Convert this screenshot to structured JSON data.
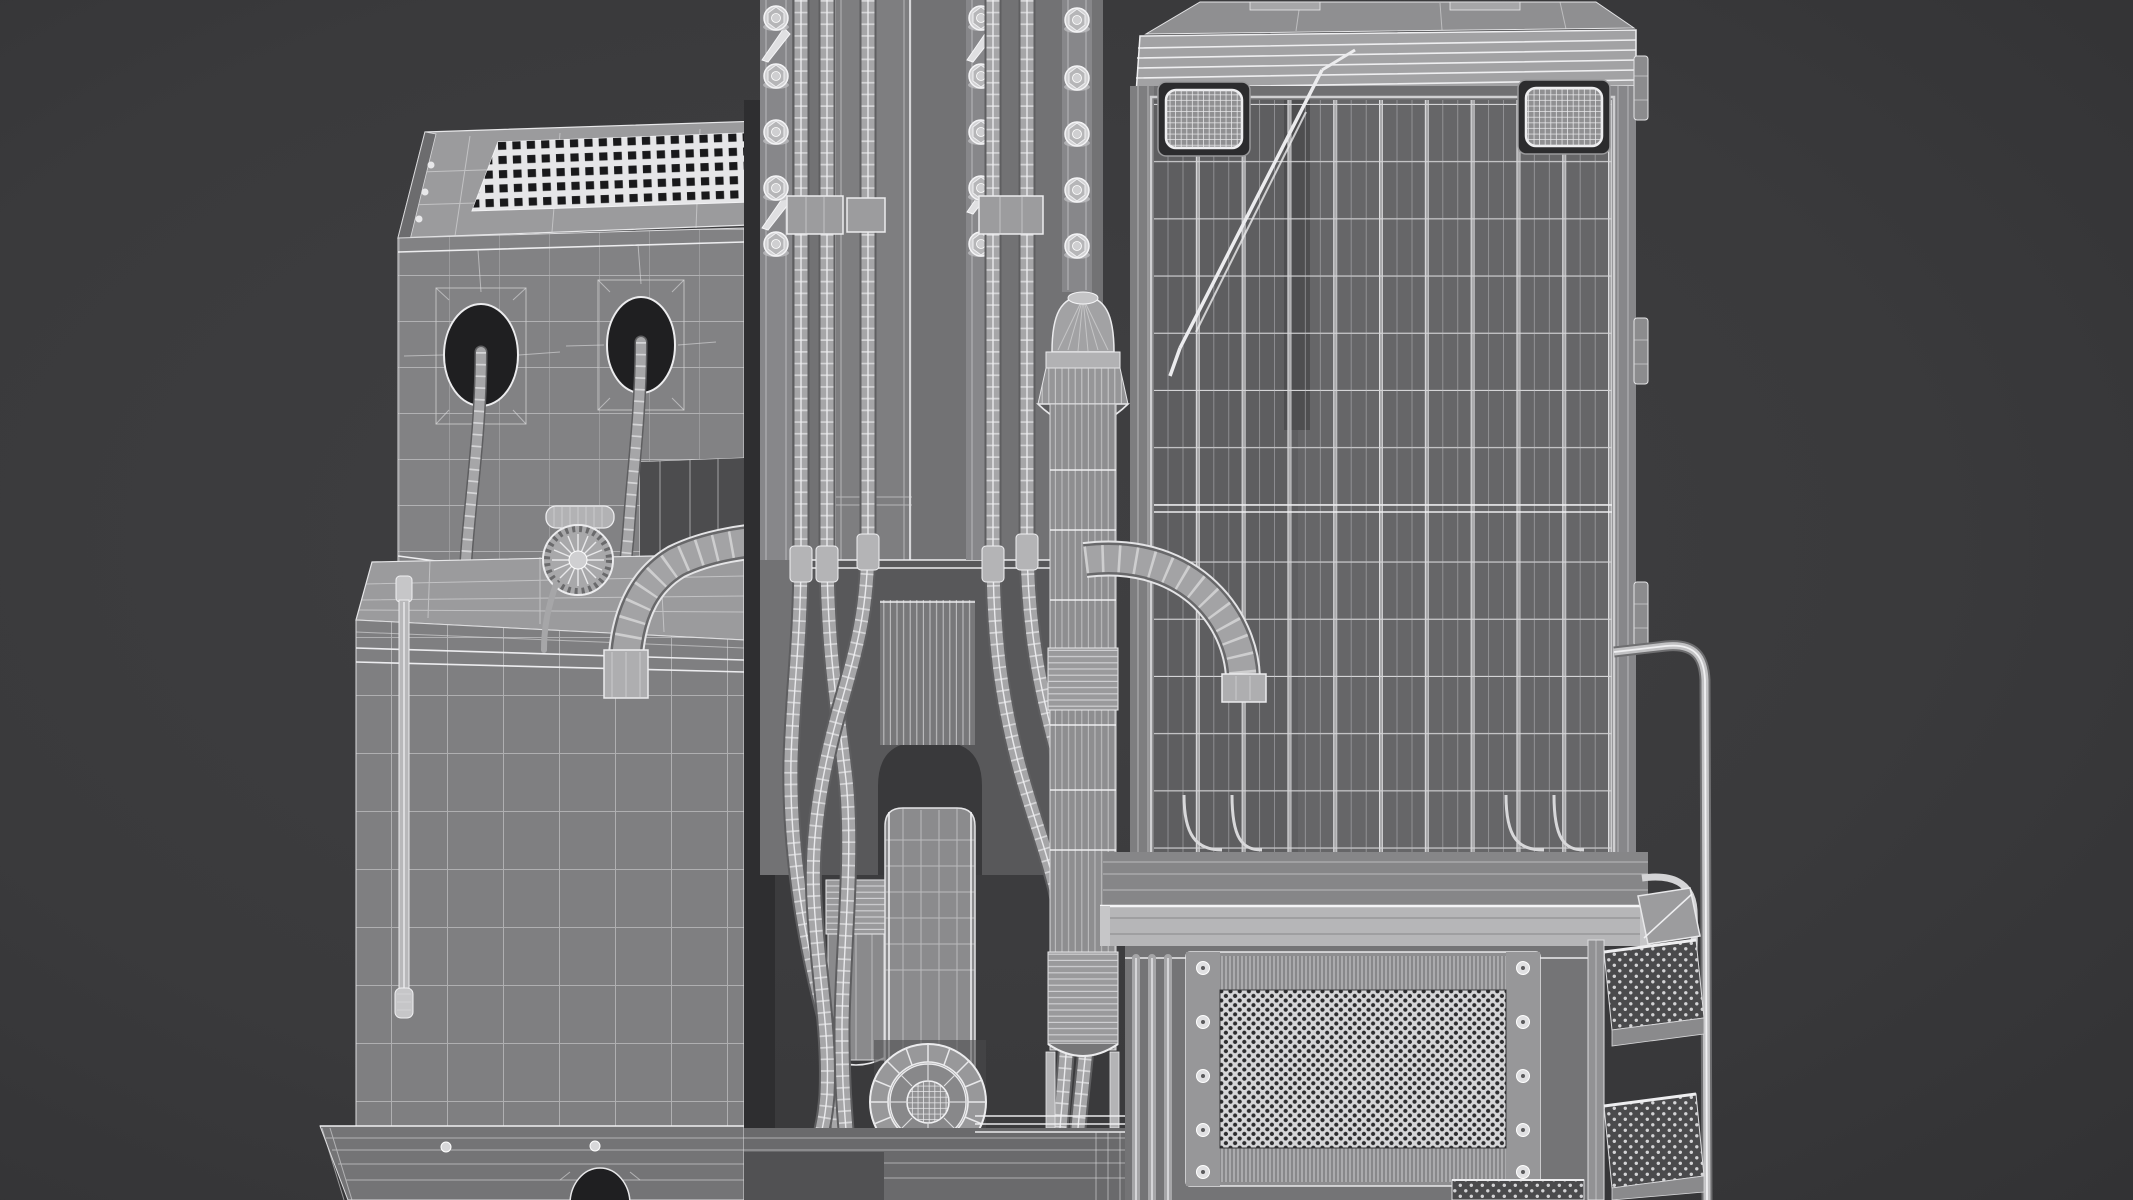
{
  "scene": {
    "title": "Grayscale 3D wireframe render of a crawler drilling rig (rear close-up) on a dark gray background",
    "render_style": "wireframe-over-shaded, monochrome",
    "background": "#3a3a3c",
    "colors": {
      "bg": "#3a3a3c",
      "bgDeep": "#323234",
      "panelEngine": "#828284",
      "panelTank": "#7f7f81",
      "panelTop": "#9b9b9d",
      "mastBack": "#727274",
      "mastCol": "#7e7e80",
      "flange": "#87878a",
      "recess": "#58585a",
      "archDark": "#39393b",
      "cabinet": "#6f6f71",
      "cabinetInner": "#666668",
      "cabinetInnerDark": "#5e5e60",
      "roof": "#8f8f91",
      "fascia": "#a2a2a4",
      "ledge": "#b6b6b8",
      "bay": "#747476",
      "radFrame": "#8e8e90",
      "radCore": "#d6d6d8",
      "tread": "#4a4a4c",
      "holeDark": "#1f1f21",
      "wire": "#dcdcde",
      "wireBright": "#f2f2f4",
      "steel": "#c8c8ca"
    },
    "parts": [
      {
        "id": "engine-box",
        "label": "Engine box with perforated top grille, two hose ports and a cooling fan"
      },
      {
        "id": "hydraulic-tank",
        "label": "Hydraulic tank with level-gauge pipe and base skirt"
      },
      {
        "id": "mast",
        "label": "Drill mast with three bolted flange columns and five cable tracks"
      },
      {
        "id": "elbow-duct-left",
        "label": "Left elbow duct onto tank top"
      },
      {
        "id": "elbow-duct-right",
        "label": "Right elbow duct in front of cabinet"
      },
      {
        "id": "main-cylinder",
        "label": "Main hydraulic cylinder with ribbed crown and corrugated bands"
      },
      {
        "id": "secondary-cylinder",
        "label": "Secondary ribbed cylinder"
      },
      {
        "id": "feed-carriage",
        "label": "Feed carriage with spoked rotary drive disk"
      },
      {
        "id": "power-cabinet",
        "label": "Power cabinet with mesh guard cage, two mesh headlights and wiper rod"
      },
      {
        "id": "walkway-ledge",
        "label": "Bright walkway ledge below the cage"
      },
      {
        "id": "radiator-panel",
        "label": "Perforated radiator panel with bolted side strips"
      },
      {
        "id": "access-steps",
        "label": "Access steps with handrail and perforated treads"
      },
      {
        "id": "base-frame",
        "label": "Base frame band with drain hole"
      }
    ],
    "counts": {
      "mast_bolt_columns": 3,
      "bolts_per_column": 5,
      "cable_tracks": 5,
      "cage_vertical_bars": 11,
      "headlights": 2,
      "radiator_bolts_per_strip": 5,
      "step_treads": 3
    }
  }
}
